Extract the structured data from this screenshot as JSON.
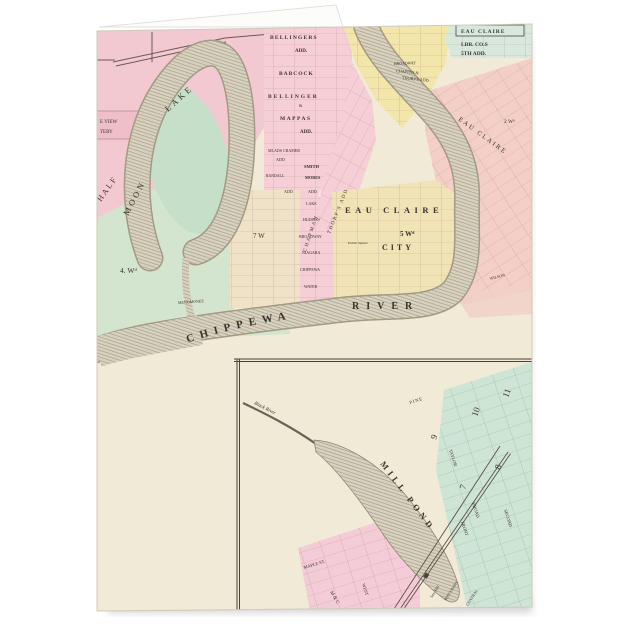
{
  "product": {
    "type": "folded greeting card preview",
    "background": "#ffffff"
  },
  "colors": {
    "card_paper": "#fcfcfa",
    "map_base": "#f0ead7",
    "pink": "#f2c9d1",
    "pink_grid": "#f5ced6",
    "green": "#d3e5cf",
    "lake": "#c6dfc9",
    "yellow_top": "#f2e6aa",
    "city_yellow": "#f0e4b6",
    "cream_grid": "#efe2c6",
    "teal": "#d8e8dc",
    "salmon": "#f3cfc7",
    "inset_green": "#cee4d4",
    "inset_pink": "#f4ccd7",
    "water_base": "#d8d2c0",
    "water_line": "#a69d87",
    "ink": "#3a332c",
    "grid_line": "#a8837b"
  },
  "map": {
    "labels": {
      "cemetery_line1": "E VIEW",
      "cemetery_line2": "TERY",
      "lake_half": "HALF",
      "lake_moon": "MOON",
      "lake_lake": "LAKE",
      "ward_4": "4. Wᵈ",
      "ward_7": "7 W",
      "ward_5": "5 Wᵈ",
      "ward_2": "2 Wᵈ",
      "bellingers": "BELLINGERS",
      "bellingers_add": "ADD.",
      "babcock": "BABCOCK",
      "bellinger": "BELLINGER",
      "amp": "&",
      "mappas": "MAPPAS",
      "mappas_add": "ADD.",
      "mlads_cramer": "MLADS CRAMER",
      "cramer_add": "ADD.",
      "smith": "SMITH",
      "randall": "RANDALL",
      "mores": "MORES",
      "mores_add1": "ADD.",
      "mores_add2": "ADD.",
      "ec_lbr_title": "EAU CLAIRE",
      "ec_lbr_1": "LBR. CO.S",
      "ec_lbr_2": "5TH ADD.",
      "broadway_top": "BROADWAY",
      "chappas": "CHAPPAS &",
      "thorps_add_top": "THORP'S ADD.",
      "thorps_add_diag": "THORP'S ADD",
      "chapman": "CHAPMAN",
      "ec_diag": "EAU CLAIRE",
      "city_line1": "EAU CLAIRE",
      "city_line2": "CITY",
      "public_square": "Public Square",
      "st_lake": "LAKE",
      "st_hudson": "HUDSON",
      "st_broadway": "BROADWAY",
      "st_niagara": "NIAGARA",
      "st_chippewa": "CHIPPEWA",
      "st_water": "WATER",
      "st_menomonee": "MENOMONEE",
      "st_wilson": "WILSON",
      "river_chippewa": "CHIPPEWA",
      "river_river": "RIVER"
    }
  },
  "inset": {
    "labels": {
      "black_river": "Black River",
      "mill_pond": "MILL POND",
      "pine": "PINE",
      "taylor": "TAYLOR",
      "broad": "BROAD",
      "second": "SECOND",
      "front": "FRONT",
      "maple": "MAPLE ST.",
      "west": "WEST",
      "mc": "M & C",
      "wisconsin": "WISCONSIN",
      "central": "CENTRAL",
      "saw_mill": "Saw Mill",
      "block_7": "7",
      "block_8": "8",
      "block_9": "9",
      "block_10": "10",
      "block_11": "11"
    }
  }
}
